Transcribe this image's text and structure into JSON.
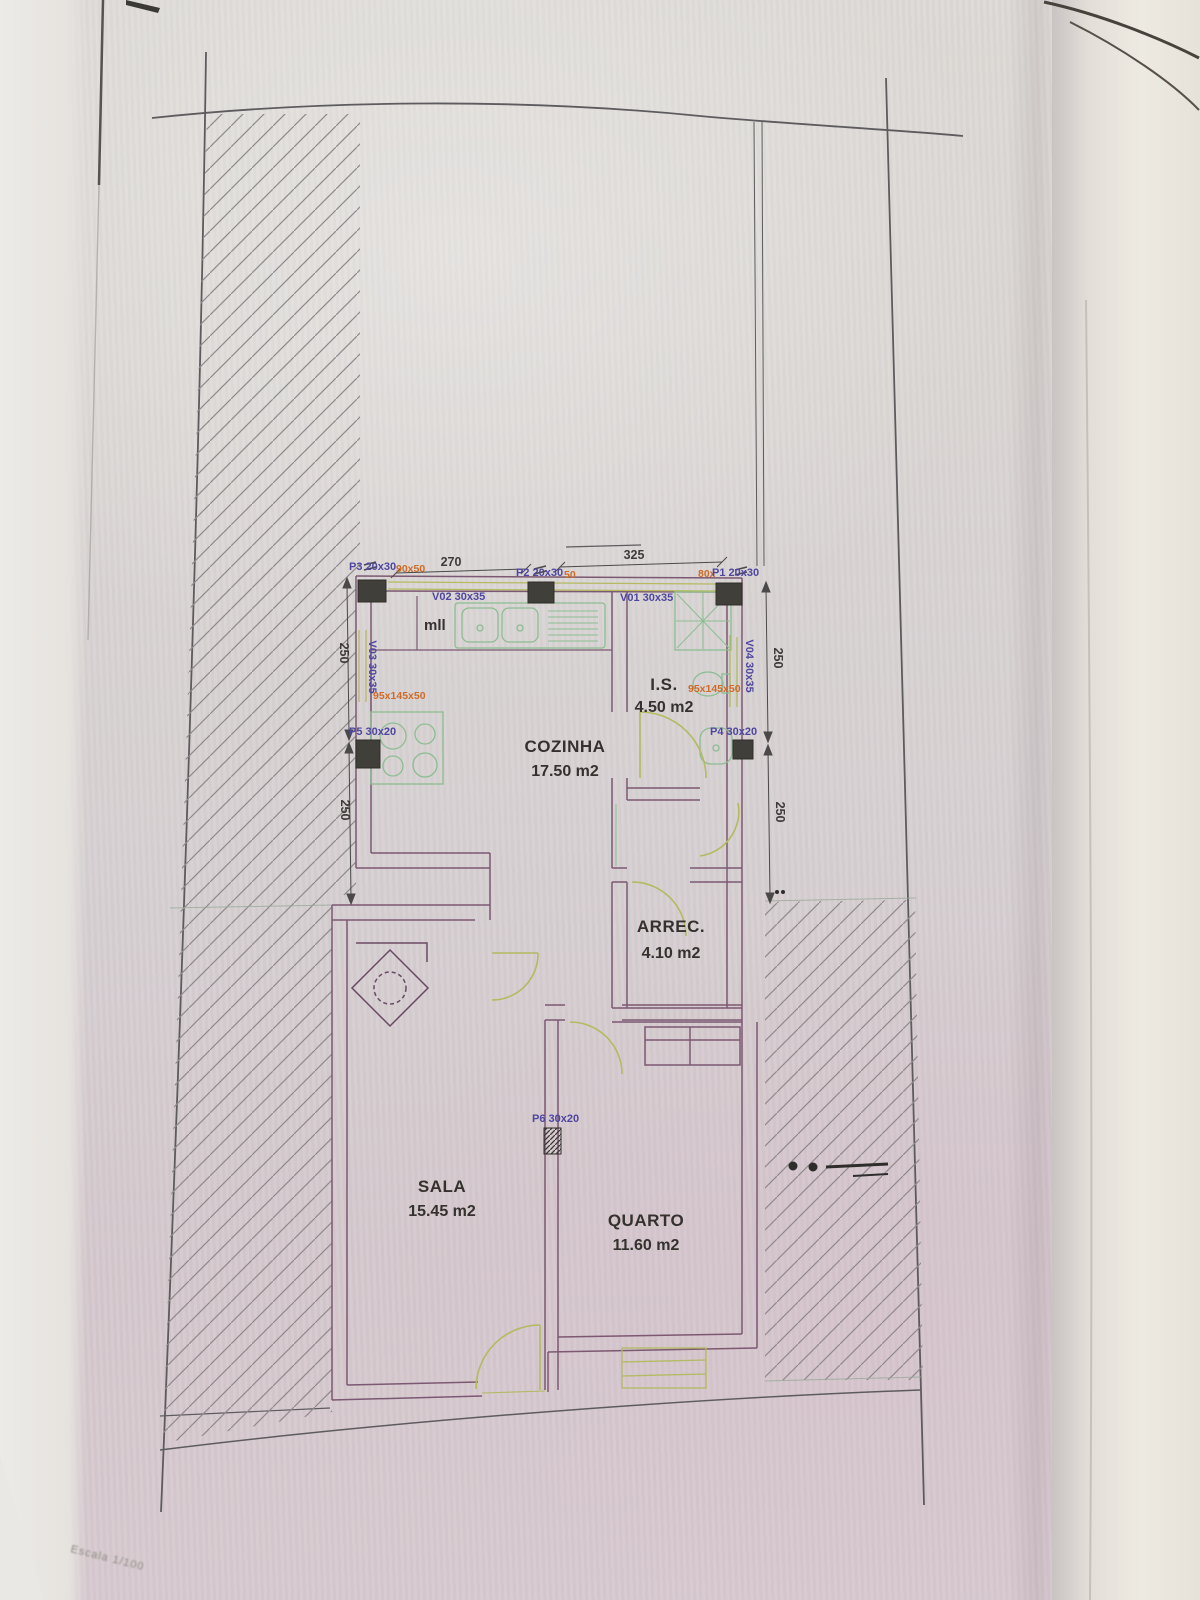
{
  "photo": {
    "scale_note": "Escala 1/100"
  },
  "plan": {
    "rooms": [
      {
        "id": "cozinha",
        "name": "COZINHA",
        "area": "17.50 m2"
      },
      {
        "id": "is",
        "name": "I.S.",
        "area": "4.50 m2"
      },
      {
        "id": "arrec",
        "name": "ARREC.",
        "area": "4.10 m2"
      },
      {
        "id": "sala",
        "name": "SALA",
        "area": "15.45 m2"
      },
      {
        "id": "quarto",
        "name": "QUARTO",
        "area": "11.60 m2"
      }
    ],
    "openings": {
      "p1": "P1 20x30",
      "p2": "P2 20x30",
      "p3": "P3 20x30",
      "p4": "P4 30x20",
      "p5": "P5 30x20",
      "p6": "P6 30x20",
      "v01": "V01 30x35",
      "v02": "V02 30x35",
      "v03": "V03 30x35",
      "v04": "V04 30x35"
    },
    "size_notes": {
      "p3_extra": "90x50",
      "p2_extra": "50",
      "p1_extra": "80x",
      "bath_left": "95x145x50",
      "bath_right": "95x145x50"
    },
    "dimensions": {
      "top_left": "270",
      "top_right": "325",
      "left_upper": "250",
      "left_lower": "250",
      "right_upper": "250",
      "right_lower": "250"
    },
    "labels": {
      "dishwasher": "mll"
    }
  },
  "colors": {
    "wall": "#7c5872",
    "fixture_green": "#8cbd92",
    "door_green": "#b3ba60",
    "label_purple": "#4f46a0",
    "label_orange": "#cf6a28",
    "text_black": "#34312e",
    "boundary": "#5d5b5e",
    "pillar_fill": "#413f39"
  }
}
